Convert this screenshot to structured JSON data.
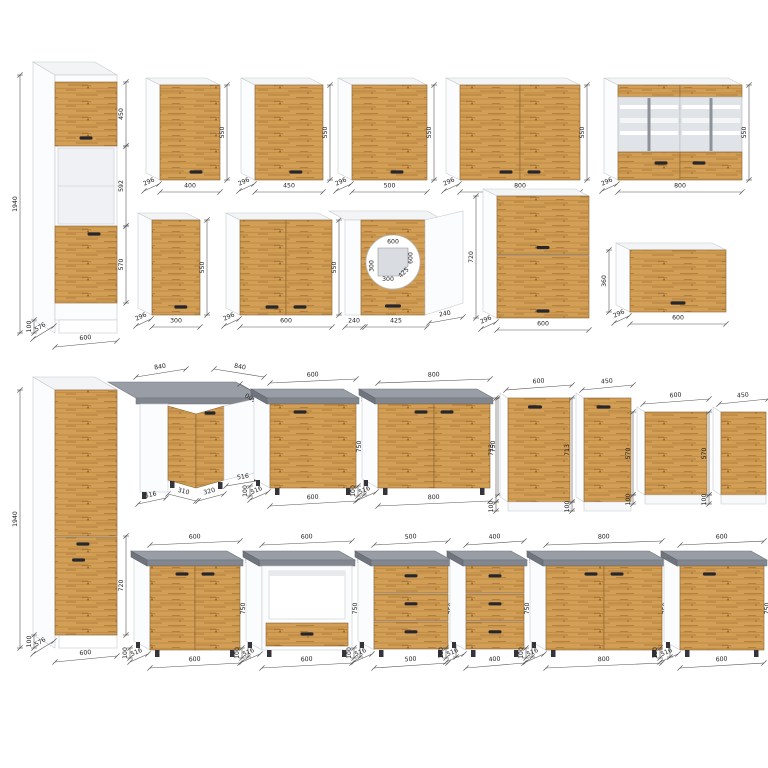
{
  "page": {
    "background": "#ffffff"
  },
  "palette": {
    "wood_base": "#d39e55",
    "wood_dark": "#b07c38",
    "wood_line": "#9c6a2c",
    "carcass_white": "#fbfcfd",
    "carcass_top": "#f3f4f6",
    "carcass_stroke": "#c6cace",
    "worktop_top": "#989da6",
    "worktop_front": "#82878f",
    "worktop_side": "#70757d",
    "glass": "#e0e4e8",
    "handle": "#26262b",
    "dim_line": "#555555",
    "dim_text": "#222222"
  },
  "modules": [
    {
      "name": "tall-oven-cabinet-600",
      "kind": "tall_oven",
      "x": 55,
      "y": 75,
      "w": 62,
      "bodyH": 245,
      "plinthH": 13,
      "dx": 22,
      "dy": 13,
      "dims": {
        "height": "1940",
        "plinth": "100",
        "depth": "576",
        "width": "600",
        "sections": [
          "450",
          "592",
          "570"
        ]
      }
    },
    {
      "name": "wall-cabinet-400",
      "kind": "wall",
      "x": 160,
      "y": 85,
      "w": 60,
      "h": 95,
      "doors": 1,
      "dims": {
        "width": "400",
        "depth": "296",
        "height": "550"
      }
    },
    {
      "name": "wall-cabinet-450",
      "kind": "wall",
      "x": 255,
      "y": 85,
      "w": 68,
      "h": 95,
      "doors": 1,
      "dims": {
        "width": "450",
        "depth": "296",
        "height": "550"
      }
    },
    {
      "name": "wall-cabinet-500",
      "kind": "wall",
      "x": 352,
      "y": 85,
      "w": 75,
      "h": 95,
      "doors": 1,
      "dims": {
        "width": "500",
        "depth": "296",
        "height": "550"
      }
    },
    {
      "name": "wall-cabinet-800",
      "kind": "wall",
      "x": 460,
      "y": 85,
      "w": 120,
      "h": 95,
      "doors": 2,
      "dims": {
        "width": "800",
        "depth": "296",
        "height": "550"
      }
    },
    {
      "name": "wall-glass-cabinet-800",
      "kind": "wall_glass",
      "x": 618,
      "y": 85,
      "w": 124,
      "h": 95,
      "dims": {
        "width": "800",
        "depth": "296",
        "height": "550"
      }
    },
    {
      "name": "wall-cabinet-300",
      "kind": "wall",
      "x": 152,
      "y": 220,
      "w": 48,
      "h": 95,
      "doors": 1,
      "dims": {
        "width": "300",
        "depth": "296",
        "height": "550"
      }
    },
    {
      "name": "wall-cabinet-600",
      "kind": "wall",
      "x": 240,
      "y": 220,
      "w": 92,
      "h": 95,
      "doors": 2,
      "dims": {
        "width": "600",
        "depth": "296",
        "height": "550"
      }
    },
    {
      "name": "wall-corner-cabinet-600x600",
      "kind": "wall_corner",
      "x": 345,
      "y": 220,
      "w": 118,
      "h": 95,
      "dims": {
        "bottoms": [
          "240",
          "425",
          "240"
        ],
        "plan": [
          "600",
          "600",
          "300",
          "300",
          "425"
        ]
      }
    },
    {
      "name": "wall-cabinet-600-two-tier",
      "kind": "wall_stacked",
      "x": 497,
      "y": 196,
      "w": 92,
      "h": 122,
      "dims": {
        "width": "600",
        "depth": "296",
        "height": "720"
      }
    },
    {
      "name": "wall-flip-cabinet-600",
      "kind": "wall_flip",
      "x": 630,
      "y": 250,
      "w": 96,
      "h": 62,
      "dims": {
        "width": "600",
        "depth": "296",
        "height": "360"
      }
    },
    {
      "name": "tall-cabinet-600",
      "kind": "tall_plain",
      "x": 55,
      "y": 390,
      "w": 62,
      "bodyH": 245,
      "plinthH": 13,
      "dx": 22,
      "dy": 13,
      "dims": {
        "height": "1940",
        "plinth": "100",
        "depth": "576",
        "width": "600",
        "door": "720"
      }
    },
    {
      "name": "base-corner-cabinet-840",
      "kind": "base_corner",
      "x": 140,
      "w": 120,
      "topY": 398,
      "dims": {
        "top_left": "840",
        "top_right": "840",
        "side": "600",
        "bottoms": [
          "516",
          "310",
          "320",
          "516"
        ]
      }
    },
    {
      "name": "base-cabinet-600",
      "kind": "base",
      "x": 270,
      "w": 86,
      "topY": 398,
      "doors": 1,
      "dims": {
        "width": "600",
        "depth": "516",
        "height": "750",
        "plinth": "100"
      }
    },
    {
      "name": "base-cabinet-800",
      "kind": "base",
      "x": 378,
      "w": 112,
      "topY": 398,
      "doors": 2,
      "dims": {
        "width": "800",
        "depth": "516",
        "height": "750",
        "plinth": "100"
      }
    },
    {
      "name": "front-panel-600x713",
      "kind": "panel",
      "x": 508,
      "w": 62,
      "y": 398,
      "h": 104,
      "handle": true,
      "dims": {
        "width": "600",
        "height": "713",
        "plinth": "100"
      }
    },
    {
      "name": "front-panel-450x713",
      "kind": "panel",
      "x": 584,
      "w": 47,
      "y": 398,
      "h": 104,
      "handle": true,
      "dims": {
        "width": "450",
        "height": "713",
        "plinth": "100"
      }
    },
    {
      "name": "front-panel-600x570",
      "kind": "panel",
      "x": 645,
      "w": 62,
      "y": 412,
      "h": 83,
      "handle": false,
      "dims": {
        "width": "600",
        "height": "570",
        "plinth": "100"
      }
    },
    {
      "name": "front-panel-450x570",
      "kind": "panel",
      "x": 721,
      "w": 45,
      "y": 412,
      "h": 83,
      "handle": false,
      "dims": {
        "width": "450",
        "height": "570",
        "plinth": "100"
      }
    },
    {
      "name": "base-cabinet-600-two-door",
      "kind": "base",
      "x": 150,
      "w": 90,
      "topY": 560,
      "doors": 2,
      "dims": {
        "width": "600",
        "depth": "516",
        "height": "750",
        "plinth": "100"
      }
    },
    {
      "name": "base-oven-cabinet-600",
      "kind": "base_oven",
      "x": 262,
      "w": 90,
      "topY": 560,
      "dims": {
        "width": "600",
        "depth": "516",
        "height": "750",
        "plinth": "100"
      }
    },
    {
      "name": "base-drawer-cabinet-500",
      "kind": "base_drawers",
      "x": 374,
      "w": 74,
      "topY": 560,
      "drawers": 3,
      "dims": {
        "width": "500",
        "depth": "516",
        "height": "750",
        "plinth": "100"
      }
    },
    {
      "name": "base-drawer-cabinet-400",
      "kind": "base_drawers",
      "x": 466,
      "w": 58,
      "topY": 560,
      "drawers": 3,
      "dims": {
        "width": "400",
        "depth": "516",
        "height": "750",
        "plinth": "100"
      }
    },
    {
      "name": "base-cabinet-800",
      "kind": "base",
      "x": 546,
      "w": 116,
      "topY": 560,
      "doors": 2,
      "dims": {
        "width": "800",
        "depth": "516",
        "height": "750",
        "plinth": "100"
      }
    },
    {
      "name": "base-cabinet-600-single",
      "kind": "base",
      "x": 680,
      "w": 84,
      "topY": 560,
      "doors": 1,
      "dims": {
        "width": "600",
        "depth": "516",
        "height": "750",
        "plinth": "100"
      }
    }
  ]
}
